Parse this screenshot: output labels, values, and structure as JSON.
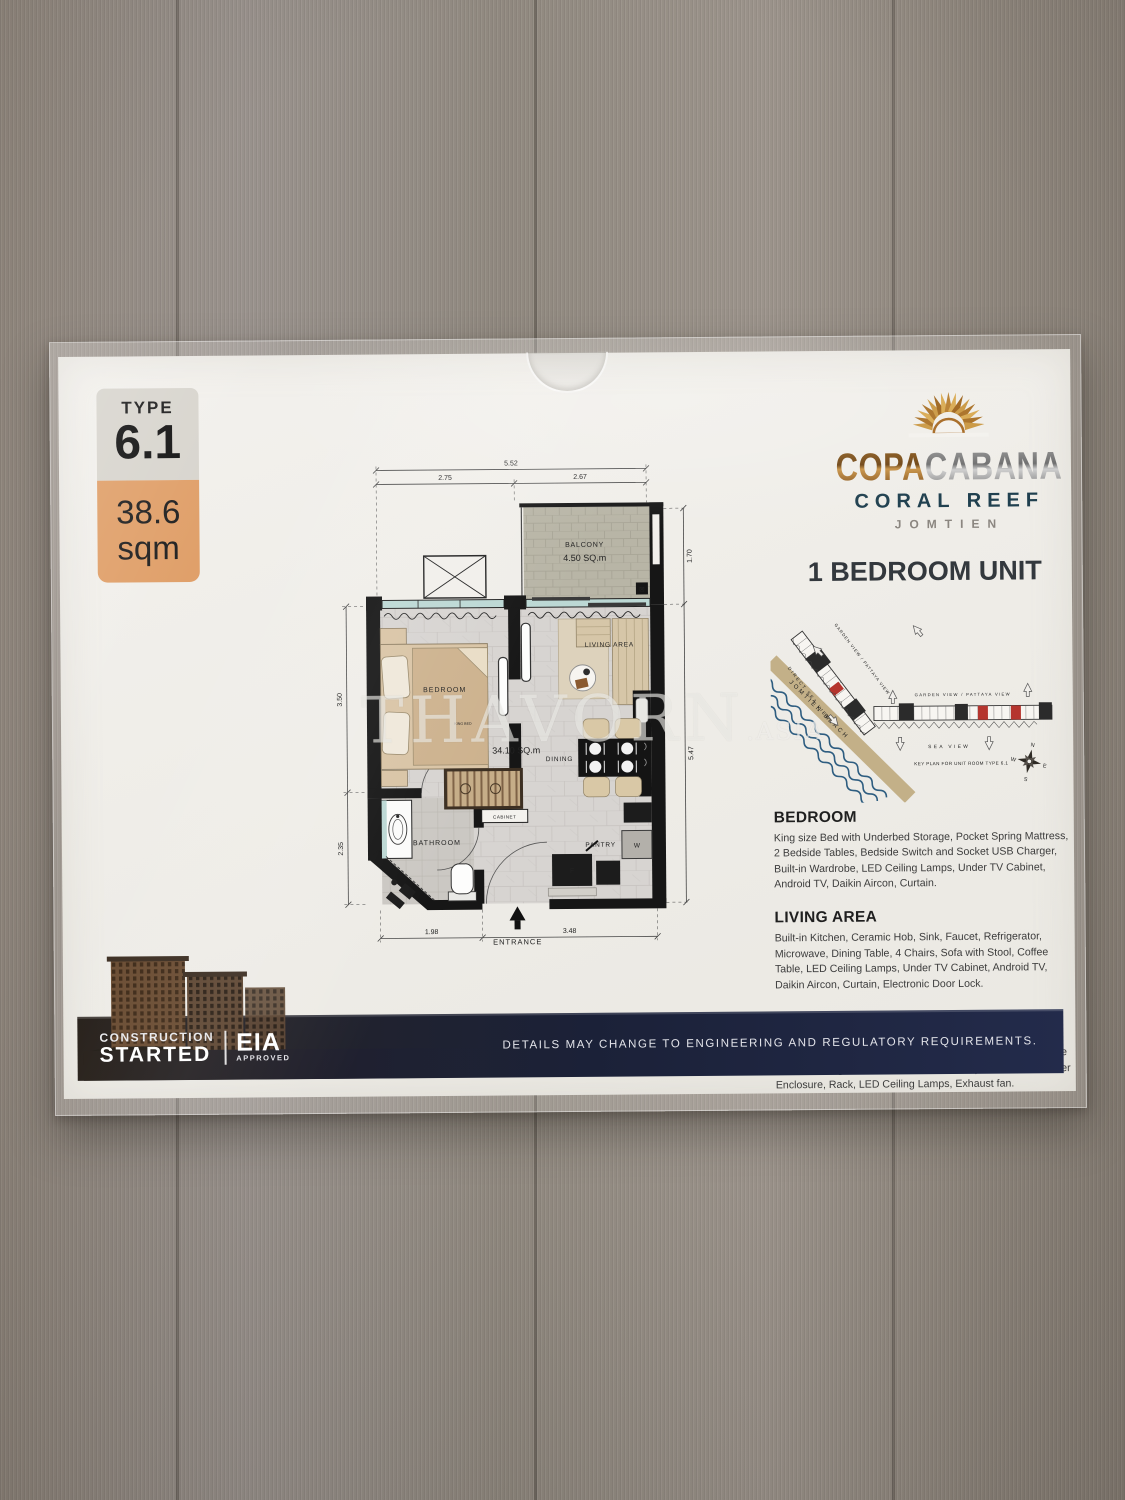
{
  "badge": {
    "type_label": "TYPE",
    "type_value": "6.1",
    "area_value": "38.6",
    "area_unit": "sqm"
  },
  "brand": {
    "word_a": "COPA",
    "word_b": "CABANA",
    "subtitle": "CORAL REEF",
    "location": "JOMTIEN"
  },
  "unit": {
    "heading": "1 BEDROOM UNIT"
  },
  "floorplan": {
    "dim_top_total": "5.52",
    "dim_top_left": "2.75",
    "dim_top_right": "2.67",
    "dim_right_top": "1.70",
    "dim_right_main": "5.47",
    "dim_left_top": "3.50",
    "dim_left_bottom": "2.35",
    "dim_bottom_left": "1.98",
    "dim_bottom_right": "3.48",
    "balcony_label": "BALCONY",
    "balcony_area": "4.50 SQ.m",
    "bedroom_label": "BEDROOM",
    "king_bed": "KING BED",
    "living_label": "LIVING AREA",
    "interior_area": "34.10 SQ.m",
    "dining_label": "DINING",
    "bathroom_label": "BATHROOM",
    "cabinet_label": "CABINET",
    "pantry_label": "PANTRY",
    "washer_label": "W",
    "fridge_label": "F",
    "entrance_label": "ENTRANCE"
  },
  "keyplan": {
    "label_diagonal": "GARDEN VIEW / PATTAYA VIEW",
    "label_direct_sea": "DIRECT SEA VIEW",
    "label_garden": "GARDEN VIEW / PATTAYA VIEW",
    "label_sea": "SEA VIEW",
    "label_beach": "JOMTIEN BEACH",
    "caption": "KEY PLAN FOR UNIT ROOM TYPE 6.1",
    "compass_n": "N",
    "compass_e": "E",
    "compass_s": "S",
    "compass_w": "W"
  },
  "sections": [
    {
      "title": "BEDROOM",
      "body": "King size Bed with Underbed Storage, Pocket Spring Mattress, 2 Bedside Tables, Bedside Switch and Socket USB Charger, Built-in Wardrobe, LED Ceiling Lamps, Under TV Cabinet, Android TV, Daikin Aircon, Curtain."
    },
    {
      "title": "LIVING AREA",
      "body": "Built-in Kitchen, Ceramic Hob, Sink, Faucet, Refrigerator, Microwave, Dining Table, 4 Chairs, Sofa with Stool, Coffee Table, LED Ceiling Lamps, Under TV Cabinet, Android TV, Daikin Aircon, Curtain, Electronic Door Lock."
    },
    {
      "title": "BATHROOM",
      "body": "Toilet, Sprayer, Brush, Paper Holder, Vanity with Sink and Faucet, Mirror with LED Light, Rain Shower, Height Adjustable Shower Fitting, Electric Water Heater, Tempered Glass Shower Enclosure, Rack, LED Ceiling Lamps, Exhaust fan."
    }
  ],
  "footer": {
    "disclaimer": "DETAILS MAY CHANGE TO ENGINEERING AND REGULATORY REQUIREMENTS.",
    "construction_top": "CONSTRUCTION",
    "construction_bottom": "STARTED",
    "eia": "EIA",
    "eia_sub": "APPROVED"
  },
  "watermark": {
    "name": "THAVORN",
    "suffix": ".ASIA"
  },
  "colors": {
    "accent_orange": "#e0a06a",
    "navy": "#1b2138",
    "keyplan_red": "#b5352e",
    "coral_teal": "#20404f"
  }
}
